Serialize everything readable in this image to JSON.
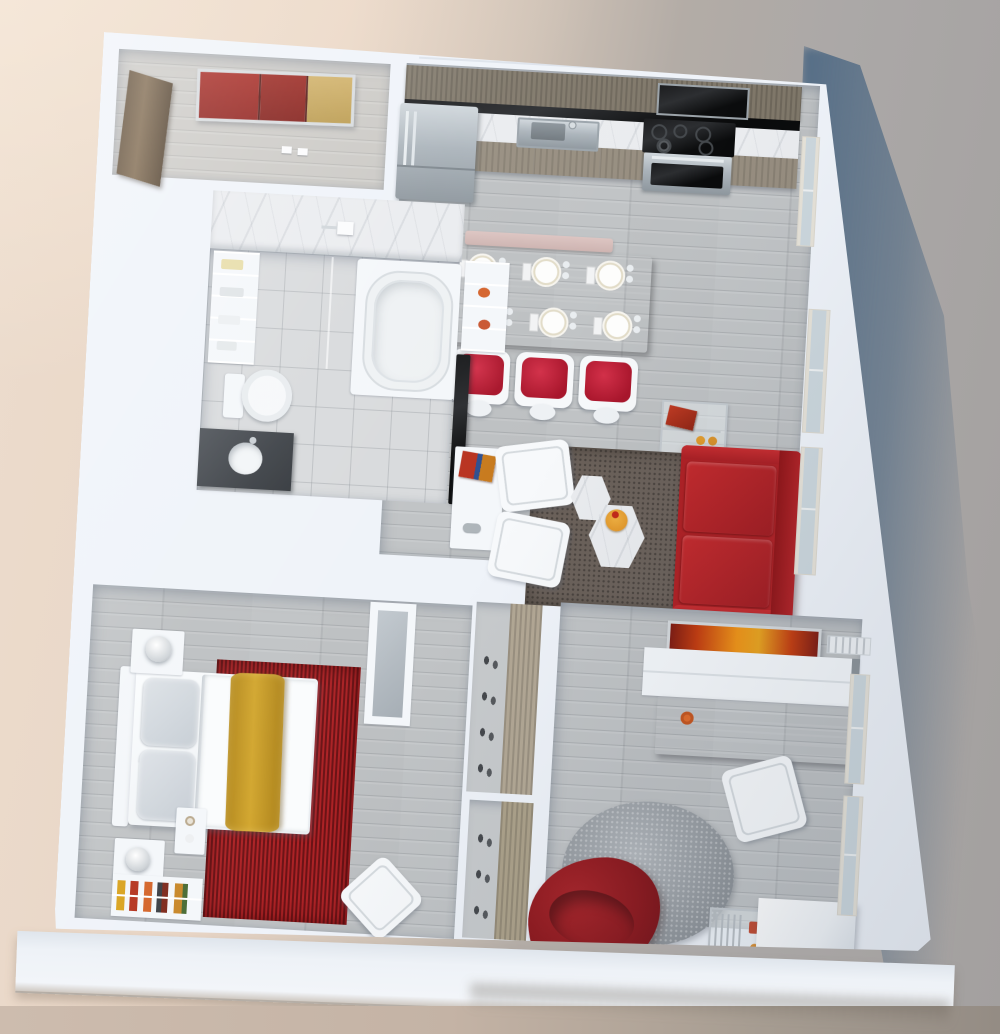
{
  "scene": {
    "title": "3d-apartment-floor-plan-render",
    "view": "top-down-3d-dollhouse",
    "palette": {
      "wall_white": "#f0f4f9",
      "floor_wood_gray": "#bdc0c2",
      "entry_floor": "#cac8c4",
      "bath_tile": "#d8dadc",
      "marble": "#eaecef",
      "cabinet_wood": "#7f7769",
      "accent_red": "#b31e24",
      "bedroom_rug_red": "#9e1c20",
      "mustard_runner": "#c79a24",
      "art_gold": "#c2a055",
      "living_rug_brown": "#6a6059",
      "den_rug_gray": "#9aa0a6",
      "stainless_steel": "#aab3ba",
      "background_left_beige": "#ead9ca",
      "background_right_gray": "#a3a09f",
      "cast_shadow_blue": "#4d6883",
      "ground_strip": "#c2b1a3"
    },
    "rooms": {
      "entry": {
        "name": "Entry Foyer",
        "furniture": [
          "red-gold-wall-art",
          "wood-closet-door",
          "light-switches"
        ]
      },
      "kitchen": {
        "name": "Kitchen",
        "furniture": [
          "refrigerator",
          "upper-cabinets",
          "black-backsplash",
          "marble-counter",
          "sink",
          "microwave",
          "cooktop",
          "oven",
          "lower-cabinets"
        ]
      },
      "dining": {
        "name": "Dining Area",
        "furniture": [
          "wood-dining-table",
          "blush-bench",
          "red-cushion-chairs x3",
          "place-settings x6"
        ]
      },
      "bathroom": {
        "name": "Bathroom",
        "furniture": [
          "bathtub",
          "shower-fixture",
          "towel-shelves",
          "toilet",
          "dark-vanity-with-sink",
          "glass-partition",
          "marble-walls"
        ]
      },
      "media_wall": {
        "name": "Media Wall",
        "furniture": [
          "wall-mounted-tv",
          "white-storage-shelf",
          "media-console",
          "books"
        ]
      },
      "living": {
        "name": "Living Room",
        "furniture": [
          "red-sofa",
          "white-lounge-chairs x2",
          "hexagon-coffee-tables",
          "dark-area-rug",
          "chrome-side-cart",
          "windows"
        ]
      },
      "bedroom": {
        "name": "Bedroom",
        "furniture": [
          "bed-with-yellow-runner",
          "red-area-rug",
          "nightstands x2",
          "table-lamps x2",
          "foot-table",
          "wardrobe",
          "low-bookshelf",
          "white-side-chair"
        ]
      },
      "closets": {
        "name": "Hall Closets",
        "furniture": [
          "shoe-closet-upper",
          "shoe-closet-lower"
        ]
      },
      "den": {
        "name": "Den / Office",
        "furniture": [
          "orange-wall-art",
          "air-vent",
          "white-credenza",
          "wood-desk",
          "desk-chair",
          "round-gray-rug",
          "red-bean-bag",
          "glass-cart",
          "white-cube-table",
          "windows"
        ]
      }
    },
    "environment": {
      "ground_left": "warm beige",
      "ground_right": "neutral gray",
      "cast_shadow": "blue-gray along right side",
      "base": "white display slab under model"
    }
  }
}
